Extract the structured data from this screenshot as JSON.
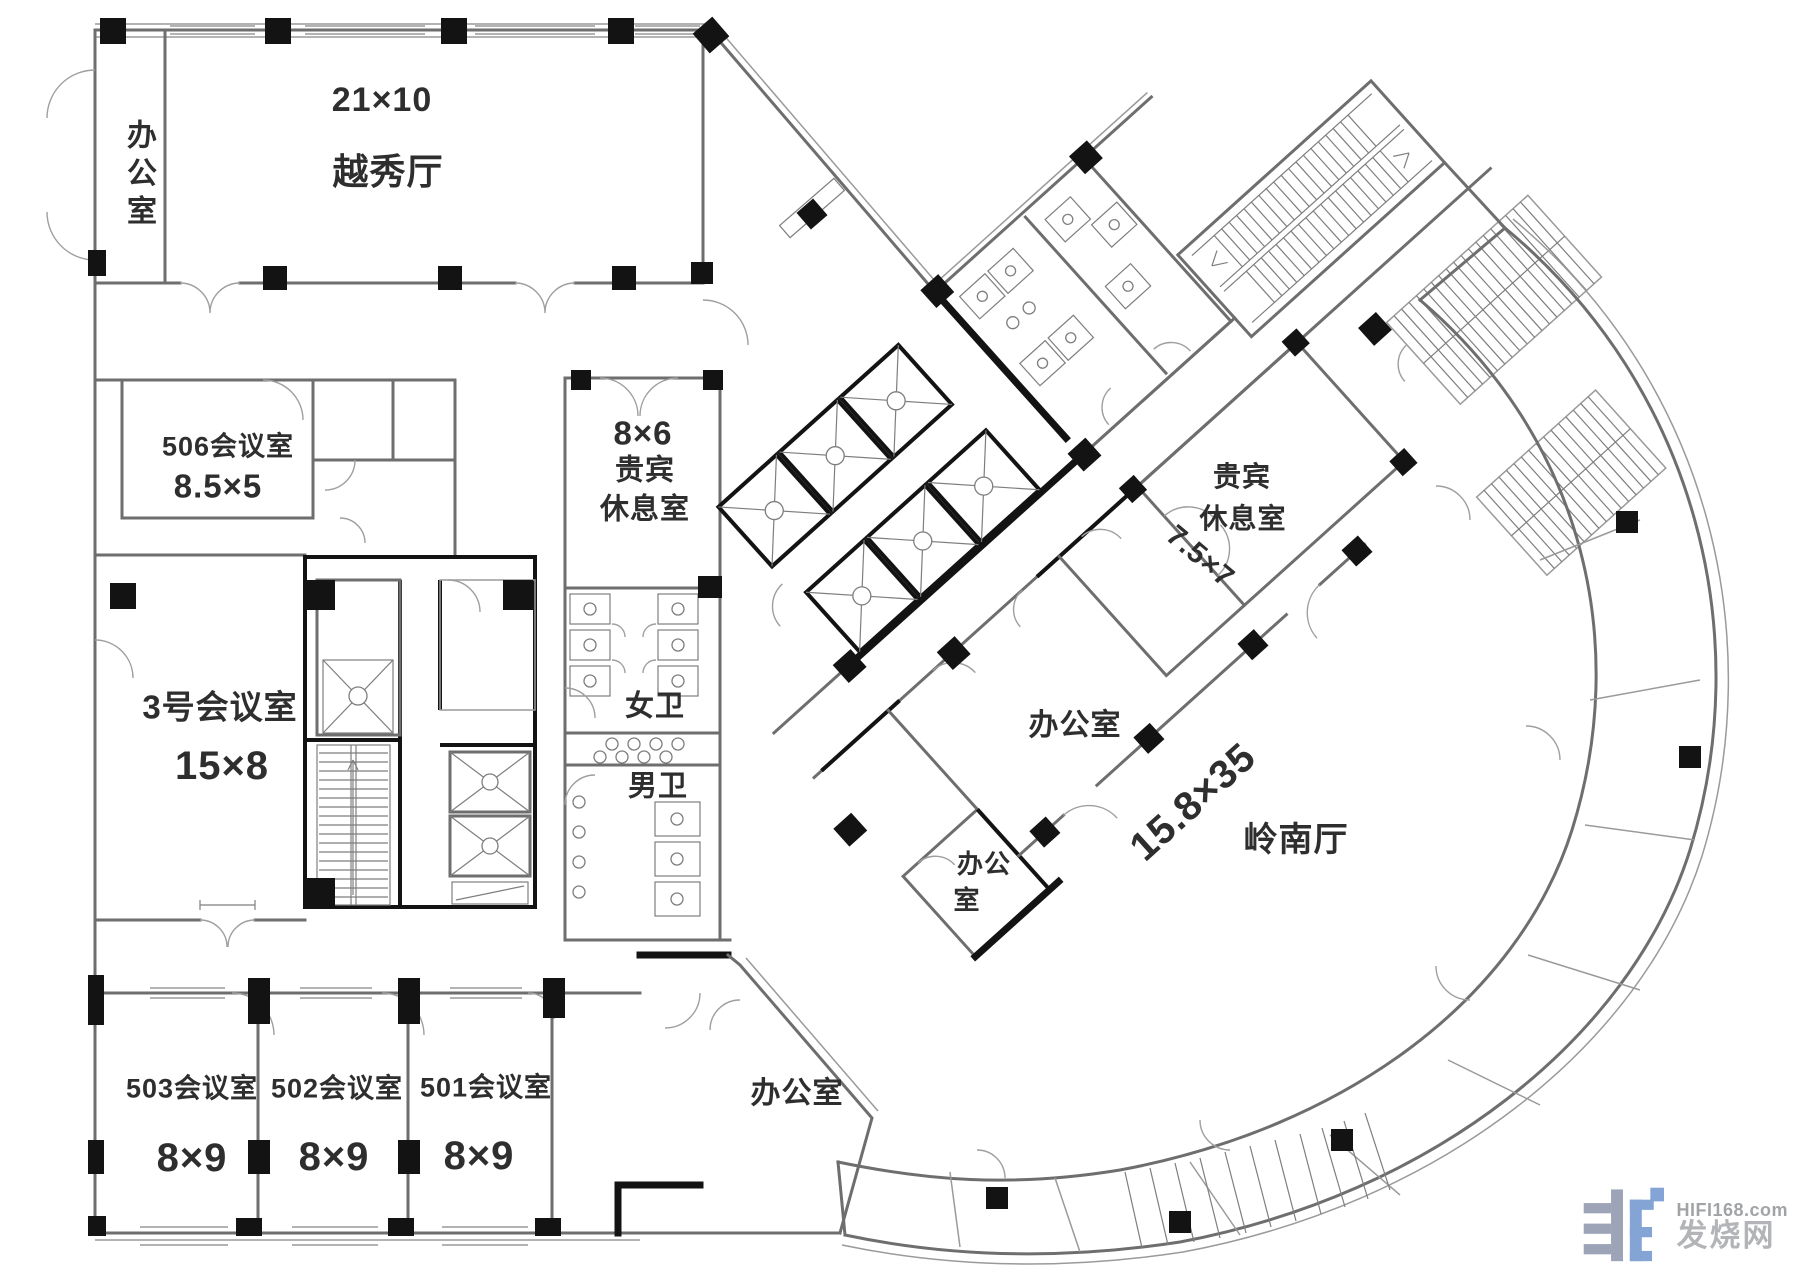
{
  "plan": {
    "rooms": {
      "office_top_left": {
        "name": "办公室"
      },
      "yuexiu": {
        "dim": "21×10",
        "name": "越秀厅"
      },
      "room506": {
        "name": "506会议室",
        "dim": "8.5×5"
      },
      "vip_west": {
        "dim": "8×6",
        "line1": "贵宾",
        "line2": "休息室"
      },
      "room3": {
        "name": "3号会议室",
        "dim": "15×8"
      },
      "wc_female": {
        "name": "女卫"
      },
      "wc_male": {
        "name": "男卫"
      },
      "vip_east": {
        "line1": "贵宾",
        "line2": "休息室",
        "dim": "7.5×7"
      },
      "office_mid": {
        "name": "办公室"
      },
      "lingnan": {
        "dim": "15.8×35",
        "name": "岭南厅"
      },
      "office_small": {
        "line1": "办公",
        "line2": "室"
      },
      "room503": {
        "name": "503会议室",
        "dim": "8×9"
      },
      "room502": {
        "name": "502会议室",
        "dim": "8×9"
      },
      "room501": {
        "name": "501会议室",
        "dim": "8×9"
      },
      "office_bottom": {
        "name": "办公室"
      }
    },
    "watermark": {
      "site": "HIFI168.com",
      "name": "发烧网"
    },
    "colors": {
      "wall_gray": "#6e6e6e",
      "wall_black": "#131313",
      "label_text": "#2e2e2e",
      "watermark_gray": "#98a0b4",
      "watermark_blue": "#7fa0d4"
    }
  }
}
